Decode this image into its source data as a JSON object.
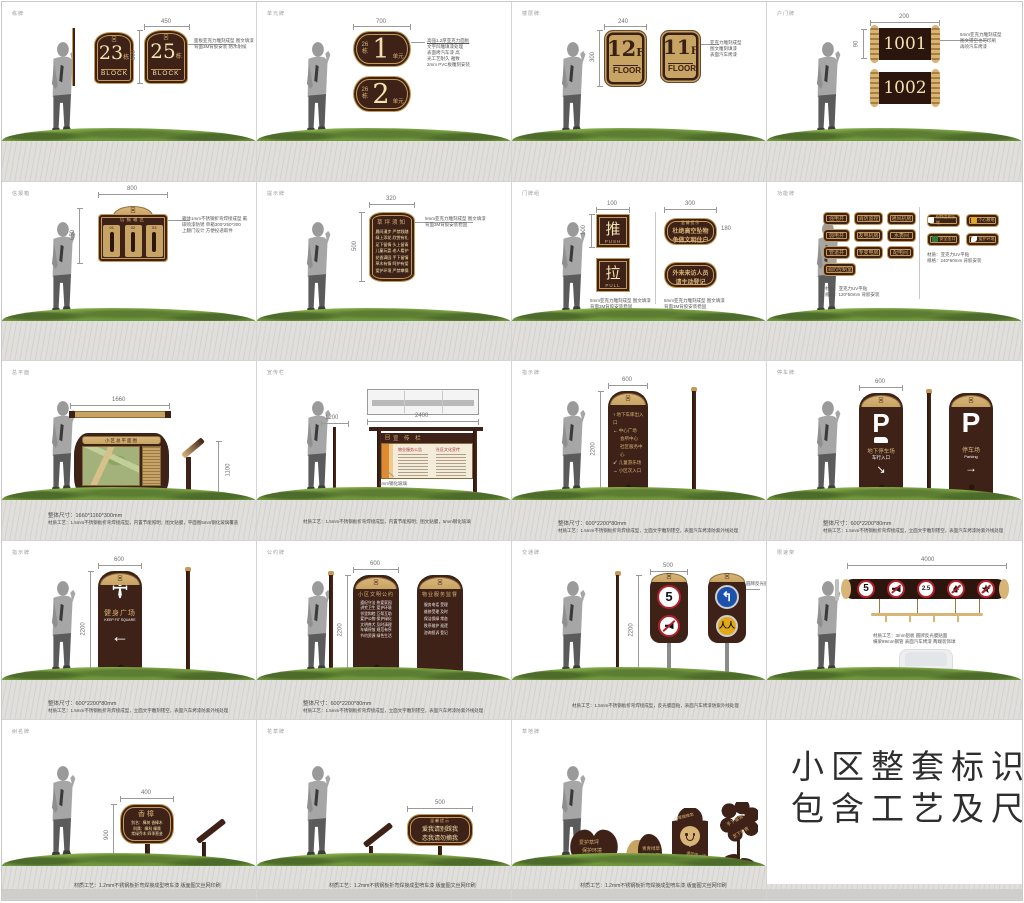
{
  "meta": {
    "title": "小区整套标识 包含工艺及尺寸"
  },
  "headline": {
    "line1": "小区整套标识",
    "line2": "包含工艺及尺寸"
  },
  "panels": {
    "p1": {
      "code": "栋牌",
      "dim_w": "450",
      "dim_h": "600",
      "logo": "回",
      "sign1": {
        "num": "23",
        "unit": "栋",
        "word": "BLOCK"
      },
      "sign2": {
        "num": "25",
        "unit": "栋",
        "word": "BLOCK"
      },
      "ann1": "面板亚克力雕刻成型 图文填漆",
      "ann2": "背面3M背胶安装 防水耐候"
    },
    "p2": {
      "code": "单元牌",
      "dim_w": "700",
      "block": "26",
      "unit_char": "栋",
      "num1": "1",
      "num2": "2",
      "suffix": "单元",
      "ann": [
        "高强1.2厚亚克力面板",
        "文字凹雕填漆处理",
        "表面烤汽车漆 高",
        "光工艺耐久 雅致",
        "2mm PVC板雕刻安装"
      ]
    },
    "p3": {
      "code": "楼层牌",
      "dim_w": "240",
      "dim_h": "300",
      "num1": "12",
      "num2": "11",
      "f": "F",
      "word": "FLOOR",
      "ann": [
        "亚克力雕刻成型",
        "图文雕刻填漆",
        "表面汽车烤漆"
      ]
    },
    "p4": {
      "code": "户门牌",
      "dim_w": "200",
      "dim_h": "90",
      "num1": "1001",
      "num2": "1002",
      "ann": [
        "5mm亚克力雕刻成型",
        "图文镂空也可印刷",
        "再喷汽车烤漆"
      ]
    },
    "p5": {
      "code": "信报箱",
      "dim_w": "800",
      "dim_h": "650",
      "logo": "回",
      "title": "信报箱区",
      "boxes": [
        "01",
        "02",
        "03"
      ],
      "ann": [
        "箱体1mm不锈钢折弯焊接成型 氟",
        "碳喷漆防锈 单箱300*250*300",
        "上翻门设计 方便投递取件"
      ]
    },
    "p6": {
      "code": "提示牌",
      "dim_w": "320",
      "dim_h": "500",
      "title": "草坪须知",
      "rows": [
        "晨间漫步 严禁践踏",
        "绿上添花 欣赏有礼",
        "足下留情 头上留青",
        "儿童玩耍 老人看护",
        "花香满园 手下留情",
        "草木有情 呵护有爱",
        "爱护环境 严禁攀摘"
      ],
      "ann": [
        "5mm亚克力雕刻成型 图文填漆",
        "背面3M背胶安装稳固"
      ]
    },
    "p7": {
      "code": "门牌组",
      "dim1": "100",
      "dim1h": "100",
      "push_char": "推",
      "push_word": "PUSH",
      "pull_char": "拉",
      "pull_word": "PULL",
      "ann_left": [
        "5mm亚克力雕刻成型 图文填漆",
        "背面3M背胶安装稳固"
      ],
      "dim2": "300",
      "dim2h": "180",
      "tip1_header": "温馨提示",
      "tip1_line1": "杜绝高空坠物",
      "tip1_line2": "争做文明住户",
      "tip2_line1": "外来来访人员",
      "tip2_line2": "请主动登记",
      "ann_right": [
        "5mm亚克力雕刻成型 图文填漆",
        "背面3M背胶安装稳固"
      ]
    },
    "p8": {
      "code": "功能牌",
      "pills": [
        "强电井",
        "消防监控",
        "通风机房",
        "弱电井",
        "发电机房",
        "水表间",
        "管道井",
        "专变电房",
        "配电间",
        "消防控制室"
      ],
      "caption_left": [
        "材质：亚克力UV平贴",
        "规格：120*50mm 背胶安装"
      ],
      "pills_right": [
        "视频监控区域",
        "小心触电",
        "安全出口",
        "爱护环境"
      ],
      "caption_right": [
        "材质：亚克力UV平贴",
        "规格：240*60mm 背胶安装"
      ]
    },
    "p9": {
      "code": "总平面",
      "dim_top": "1660",
      "title": "小区总平面图",
      "logo": "回",
      "lectern_dim": "1100",
      "caption1": "整体尺寸：1660*1160*300mm",
      "caption2": "材质工艺：1.5mm不锈钢板折弯焊接成型，内置节能照明；图文贴膜，平面图5mm钢化玻璃覆盖"
    },
    "p10": {
      "code": "宣传栏",
      "dim_top": "2400",
      "dim_side": "1200",
      "header": "宣 传 栏",
      "logo": "回",
      "glass_note": "5mm钢化玻璃",
      "poster1": "物业服务公告",
      "poster2": "社区文化宣传",
      "caption": "材质工艺：1.5mm不锈钢板折弯焊接成型，内置节能照明；图文贴膜，5mm钢化玻璃"
    },
    "p11": {
      "code": "指示牌",
      "dim_w": "600",
      "dim_h": "2200",
      "logo": "回",
      "rows": [
        {
          "arrow": "↑",
          "text": "地下车库出入口"
        },
        {
          "arrow": "←",
          "text": "中心广场"
        },
        {
          "arrow": "",
          "text": "会所中心"
        },
        {
          "arrow": "",
          "text": "社区服务中心"
        },
        {
          "arrow": "↙",
          "text": "儿童游乐场"
        },
        {
          "arrow": "→",
          "text": "小区次入口"
        }
      ],
      "view1": "正面图",
      "view2": "侧面图",
      "caption1": "整体尺寸：600*2200*80mm",
      "caption2": "材质工艺：1.5mm不锈钢板折弯焊接成型，立面文字雕刻镂空，表面汽车烤漆防紫外线处理"
    },
    "p12": {
      "code": "停车牌",
      "dim_w": "600",
      "logo": "回",
      "p": "P",
      "left_loc": "地下停车场",
      "left_sub": "车行入口",
      "left_arrow": "↘",
      "right_loc": "停车场",
      "right_sub": "Parking",
      "right_arrow": "→",
      "caption1": "整体尺寸：600*2200*80mm",
      "caption2": "材质工艺：1.5mm不锈钢板折弯焊接成型，立面文字雕刻镂空，表面汽车烤漆防紫外线处理"
    },
    "p13": {
      "code": "指示牌",
      "dim_w": "600",
      "dim_h": "2200",
      "logo": "回",
      "title": "健身广场",
      "sub": "KEEP FIT SQUARE",
      "arrow": "←",
      "caption1": "整体尺寸：600*2200*80mm",
      "caption2": "材质工艺：1.5mm不锈钢板折弯焊接成型，立面文字雕刻镂空，表面汽车烤漆防紫外线处理"
    },
    "p14": {
      "code": "公约牌",
      "dim_w": "600",
      "dim_h": "2200",
      "logo": "回",
      "t1_title": "小区文明公约",
      "t1_rows": [
        "遵纪守法 热爱家园",
        "讲究卫生 爱护环境",
        "邻里和睦 互帮互助",
        "爱护公物 保护绿化",
        "文明养犬 及时清理",
        "车辆停放 规范有序",
        "节约资源 绿色生活"
      ],
      "t2_title": "物业服务监督",
      "t2_rows": [
        "服务电话 受理",
        "维修受理 及时",
        "保洁保绿 常态",
        "秩序维护 巡逻",
        "咨询投诉 登记"
      ],
      "caption1": "整体尺寸：600*2200*80mm",
      "caption2": "材质工艺：1.5mm不锈钢板折弯焊接成型，立面文字雕刻镂空，表面汽车烤漆防紫外线处理"
    },
    "p15": {
      "code": "交通牌",
      "dim_w": "500",
      "dim_h": "2200",
      "logo": "回",
      "speed": "5",
      "yellow_icon": "人",
      "ann": "圆牌反光膜贴面",
      "caption": "材质工艺：1.5mm不锈钢板折弯焊接成型，反光膜面贴，表面汽车烤漆防紫外线处理"
    },
    "p16": {
      "code": "限速架",
      "dim_w": "4000",
      "speed": "5",
      "height_limit": "2.5",
      "note1": "材质工艺：3mm铝板 圆牌反光膜贴面",
      "note2": "横梁89mm钢管 表面汽车烤漆 两端装饰球"
    },
    "p17": {
      "code": "树名牌",
      "dim_w": "400",
      "dim_h": "900",
      "title": "香樟",
      "lines": [
        "别名：樟树 香樟木",
        "科属：樟科 樟属",
        "常绿乔木 四季葱茏"
      ],
      "caption": "材质工艺：1.2mm不锈钢板折弯焊接成型喷车漆 版面图文丝网印刷"
    },
    "p18": {
      "code": "花草牌",
      "dim_w": "500",
      "header": "温馨提示",
      "line1": "爱我请别踩我",
      "line2": "恋我请勿摘我",
      "caption": "材质工艺：1.2mm不锈钢板折弯焊接成型喷车漆 版面图文丝网印刷"
    },
    "p19": {
      "code": "草地牌",
      "s1a": "爱护草坪",
      "s1b": "保护环境",
      "s2a": "青青绿草",
      "s2b": "踏之何忍",
      "s3a": "小草微微笑",
      "s3b": "请您绕一绕",
      "s4a": "手下留情",
      "s4b": "足下留青",
      "caption": "材质工艺：1.2mm不锈钢板折弯焊接成型喷车漆 版面图文丝网印刷"
    }
  }
}
